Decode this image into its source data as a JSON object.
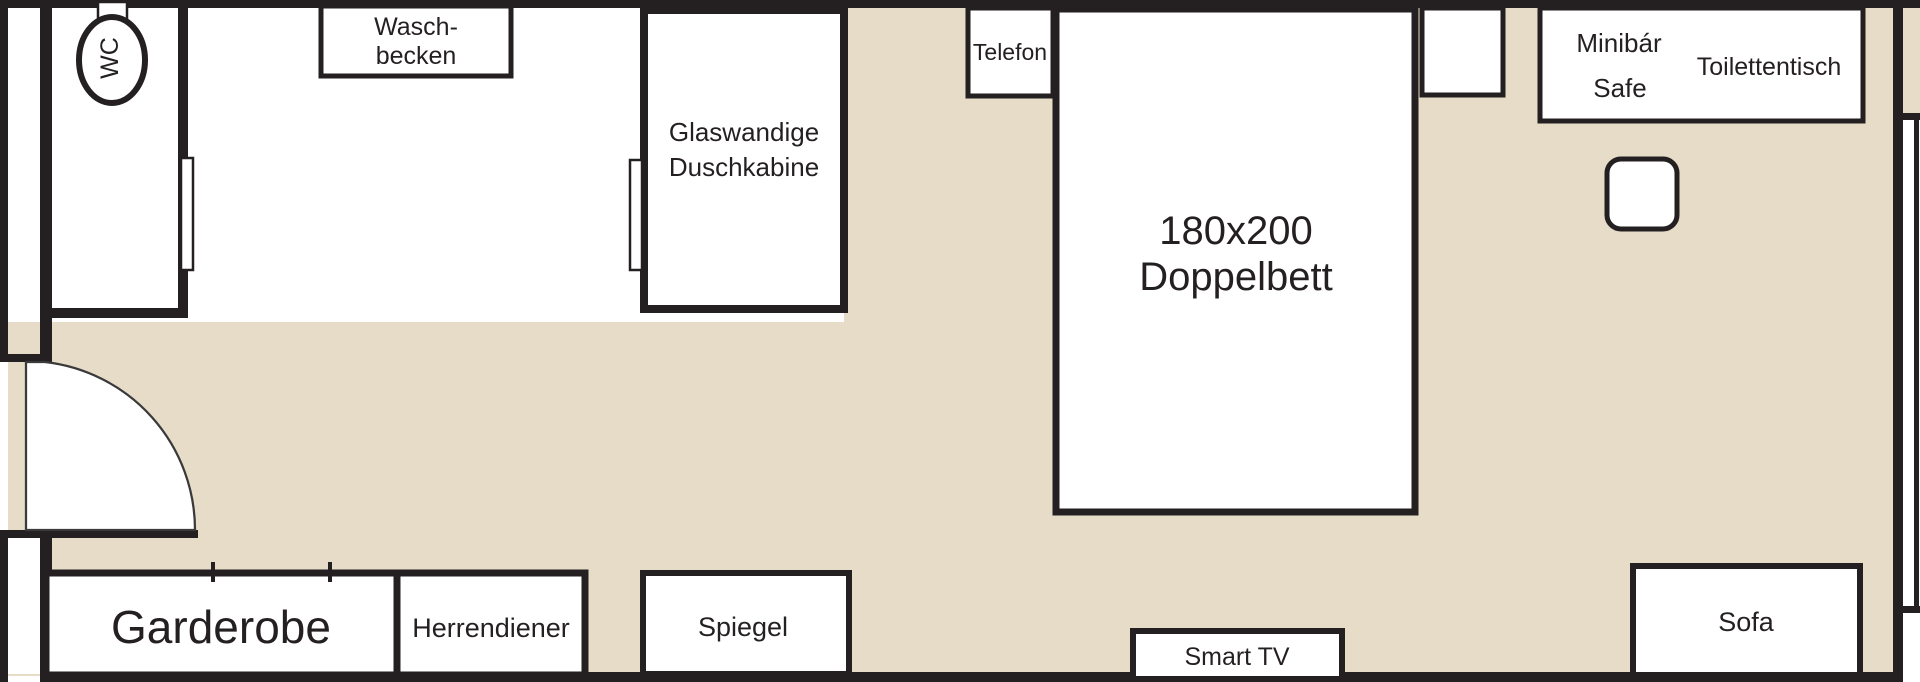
{
  "title": "Hotel room floor plan",
  "colors": {
    "floor_beige": "#e6dcc8",
    "wall_black": "#241f20",
    "furniture_white": "#ffffff"
  },
  "rooms": {
    "wc": {
      "label": "WC"
    },
    "washbasin": {
      "line1": "Wasch-",
      "line2": "becken"
    },
    "shower": {
      "line1": "Glaswandige",
      "line2": "Duschkabine"
    },
    "phone": {
      "label": "Telefon"
    },
    "bed": {
      "line1": "180x200",
      "line2": "Doppelbett"
    },
    "minibar": {
      "label": "Minibár"
    },
    "safe": {
      "label": "Safe"
    },
    "dressing_table": {
      "label": "Toilettentisch"
    },
    "wardrobe": {
      "label": "Garderobe"
    },
    "valet": {
      "label": "Herrendiener"
    },
    "mirror": {
      "label": "Spiegel"
    },
    "tv": {
      "label": "Smart TV"
    },
    "sofa": {
      "label": "Sofa"
    }
  }
}
